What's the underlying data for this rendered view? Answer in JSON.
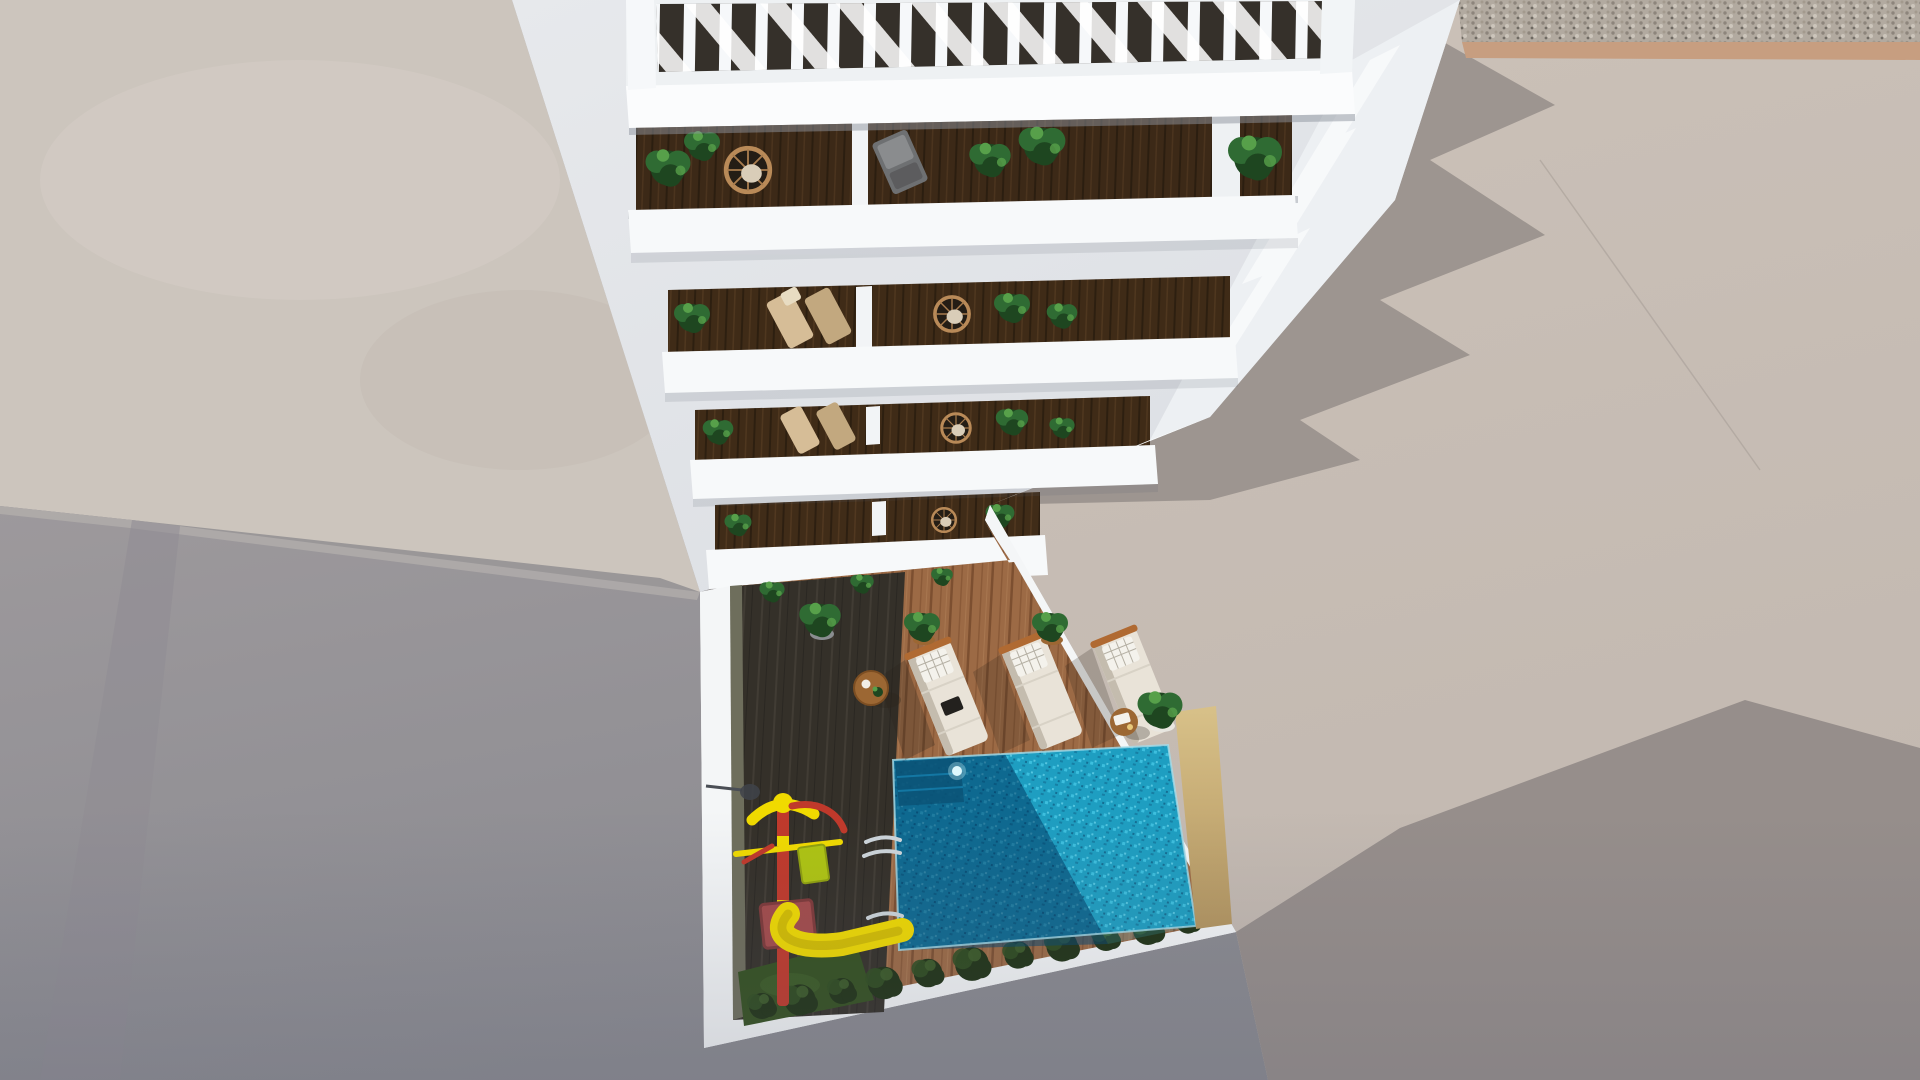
{
  "scene": {
    "description": "Aerial top-down 3D architectural rendering of a white apartment building with pergola roof terrace, four stepped balcony floors with plants and chairs, and a ground courtyard with swimming pool, wooden deck, three sun loungers and a children's slide",
    "building": {
      "pergola_slats": true,
      "balcony_rows": 4,
      "balcony_items": [
        "potted-plants",
        "wicker-chair",
        "deck-chairs",
        "gray-lounge-chair",
        "wood-decking"
      ]
    },
    "courtyard": {
      "pool": {
        "ladder": true,
        "underwater_light": true,
        "steps": true
      },
      "sun_loungers": 3,
      "side_tables": 2,
      "potted_plants": 4,
      "playground": {
        "slide": true,
        "climbing_frame": true
      },
      "hedge_plants": 12,
      "grass_patch": true
    },
    "surroundings": [
      "concrete-ground",
      "gravel-strip",
      "building-shadows"
    ]
  },
  "colors": {
    "ground_top_left": "#ccc5bd",
    "ground_left_a": "#9d999c",
    "ground_left_b": "#8a8a90",
    "ground_right": "#c2b8b0",
    "ground_right_lit": "#cbc1b8",
    "ground_shadow": "#9d9590",
    "ground_shadow_deep": "#968e8b",
    "gravel_base": "#b2aaa0",
    "gravel_trim": "#c79e80",
    "wall_backdrop": "#e7e9ec",
    "wall_recess": "#dcdfe4",
    "band_white": "#f7f9fa",
    "fascia_bright": "#fbfcfd",
    "right_face": "#edf0f3",
    "opening_dark": "#241d15",
    "opening_wood": "#54391f",
    "deck_dark": "#343029",
    "deck_dark_line": "#413c34",
    "deck_light": "#9c6a45",
    "deck_light_line": "#7c4f30",
    "pool_water": "#1795ba",
    "pool_dark": "#07456e",
    "pool_bright": "#45c8e6",
    "pool_wall_tan": "#d8c189",
    "pool_wall_tan_dark": "#b3955f",
    "grass": "#33501f",
    "hedge": "#20341574",
    "hedge_dark": "#1f3215",
    "hedge_light": "#2f4d1f",
    "plant_green": "#2f6b33",
    "plant_green_dark": "#1e4620",
    "plant_green_light": "#57a04a",
    "wicker": "#b98a58",
    "lounger_cushion": "#e9e3d8",
    "lounger_shade": "#c4bcae",
    "pillow_white": "#f4f2ec",
    "frame_orange": "#b06a32",
    "table_wood": "#9c6733",
    "slide_yellow": "#f0da00",
    "slide_red": "#c0392b",
    "platform_red": "#a34b4b",
    "panel_green": "#aec412",
    "ladder_chrome": "#cdd5da",
    "olive_wall": "#6e6e5c",
    "vignette": "#5a5f73"
  }
}
